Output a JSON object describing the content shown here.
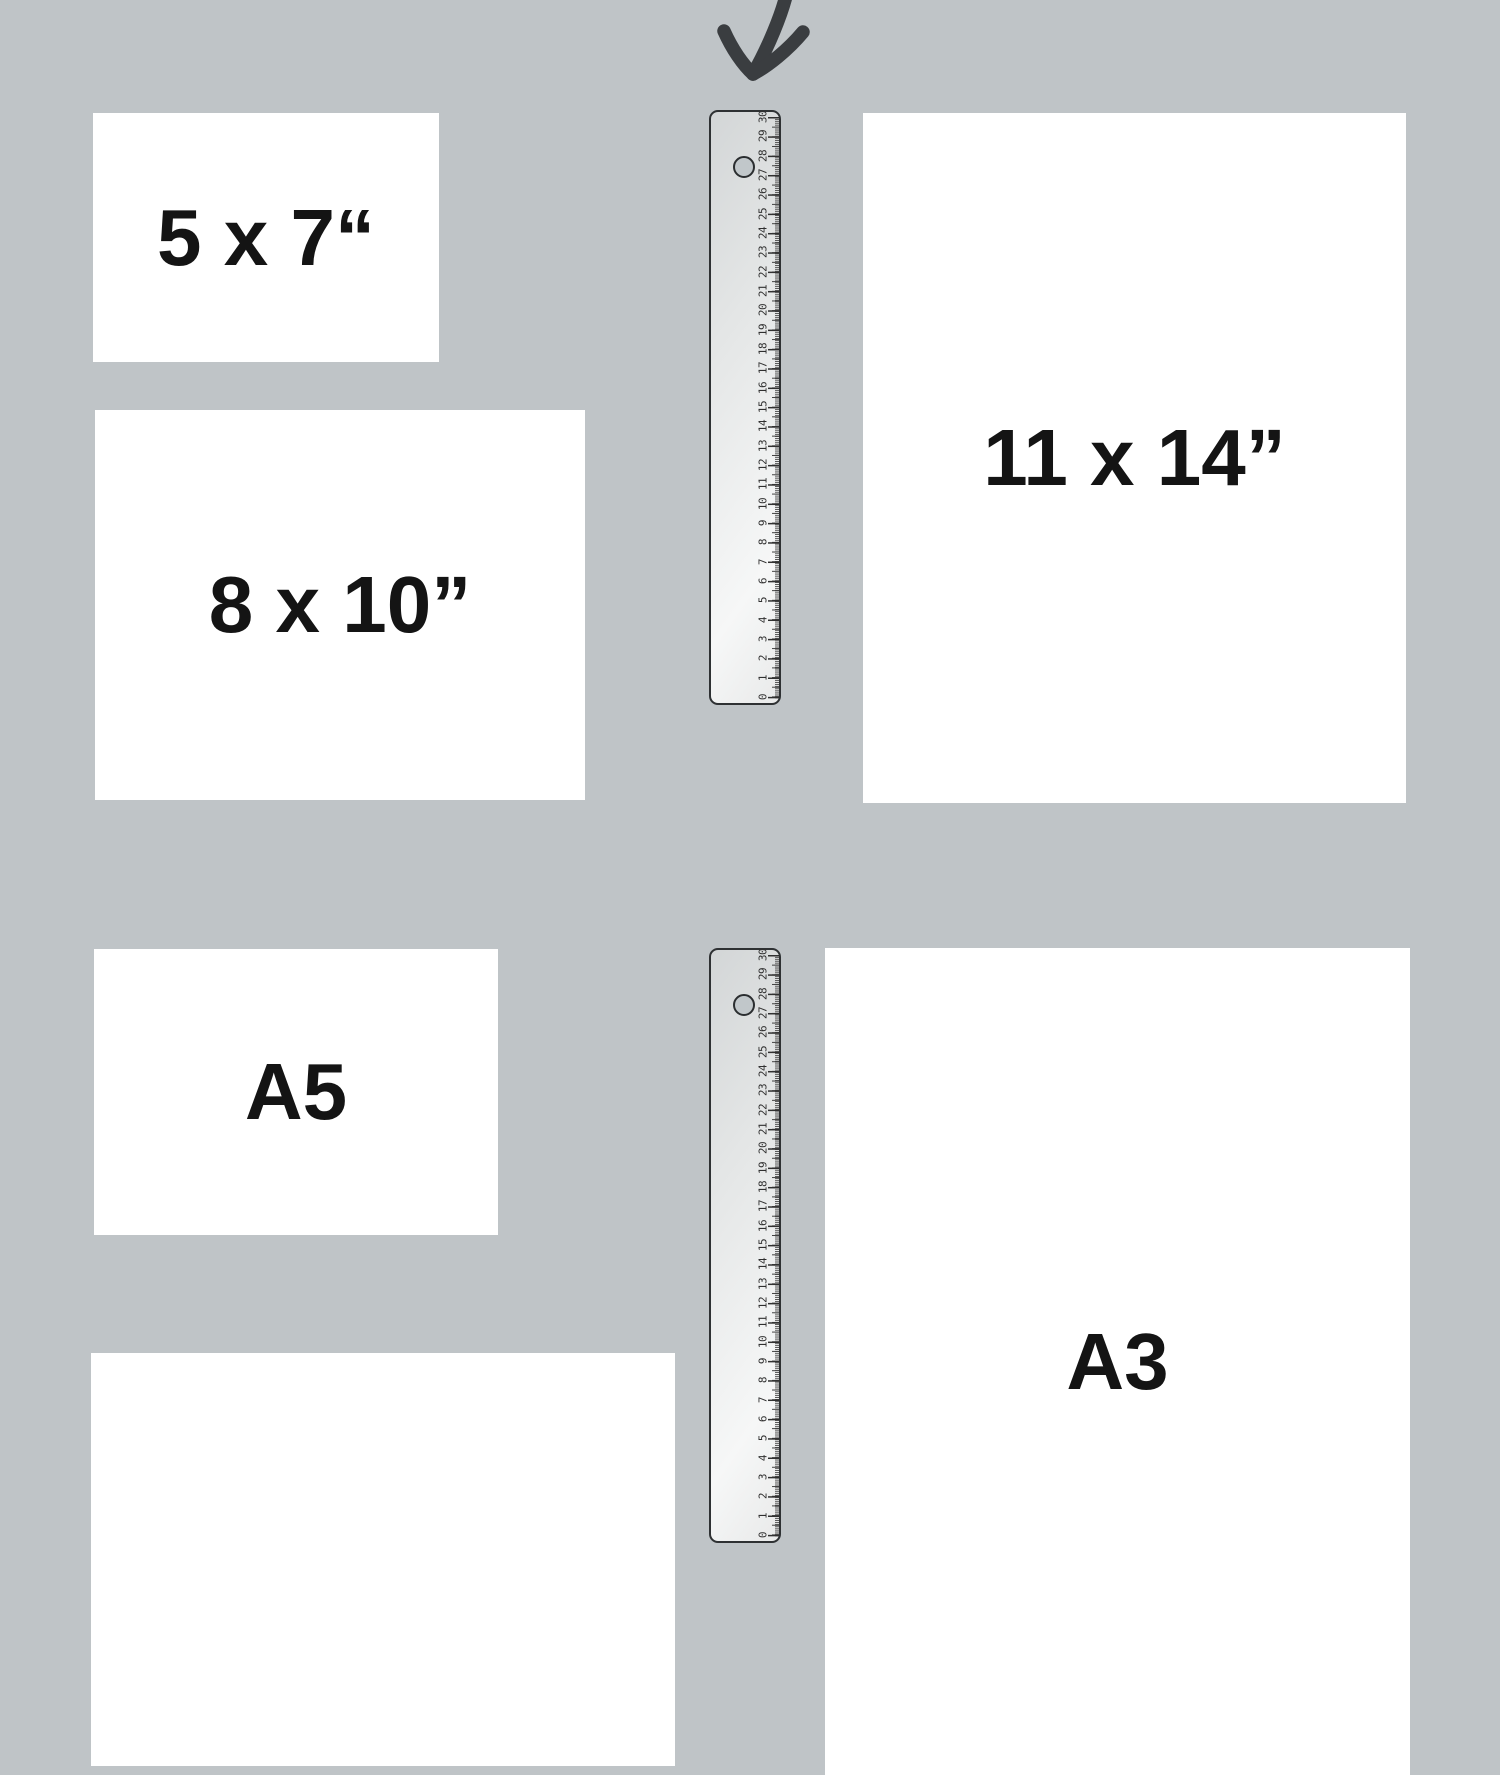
{
  "page": {
    "background_color": "#bfc4c7",
    "paper_color": "#ffffff",
    "label_color": "#141414"
  },
  "arrow": {
    "color": "#3a3d40"
  },
  "papers": [
    {
      "id": "5x7",
      "label": "5 x 7“"
    },
    {
      "id": "8x10",
      "label": "8 x 10”"
    },
    {
      "id": "11x14",
      "label": "11 x 14”"
    },
    {
      "id": "a5",
      "label": "A5"
    },
    {
      "id": "a3",
      "label": "A3"
    },
    {
      "id": "partial",
      "label": ""
    }
  ],
  "ruler": {
    "unit": "cm",
    "min": 0,
    "max": 30,
    "numbers": [
      "30",
      "29",
      "28",
      "27",
      "26",
      "25",
      "24",
      "23",
      "22",
      "21",
      "20",
      "19",
      "18",
      "17",
      "16",
      "15",
      "14",
      "13",
      "12",
      "11",
      "10",
      "9",
      "8",
      "7",
      "6",
      "5",
      "4",
      "3",
      "2",
      "1",
      "0"
    ]
  }
}
